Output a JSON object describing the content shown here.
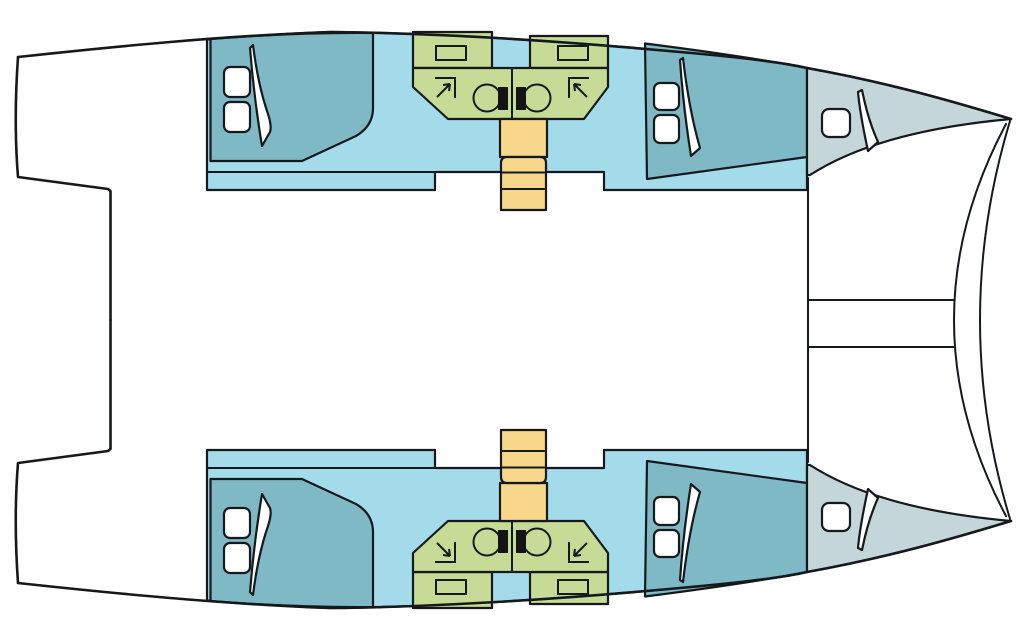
{
  "page": {
    "width": 1028,
    "height": 630,
    "background": "#ffffff"
  },
  "diagram": {
    "type": "boat-floor-plan",
    "subject": "catamaran-layout-top-down-view",
    "orientation": {
      "bow": "right",
      "stern": "left"
    },
    "colors": {
      "background": "#ffffff",
      "outline": "#15191c",
      "cabin_floor": "#a4dbeb",
      "berth": "#7fb9c6",
      "bow_locker": "#c4d6d9",
      "bathroom": "#c6db95",
      "stairs": "#f7d78a",
      "fixture_black": "#141414",
      "hatch_fill": "#ffffff"
    },
    "center_structures": {
      "bridge_deck": {
        "fill_key": "background",
        "contents": "empty"
      },
      "stern_cockpit_recess": {
        "side": "left"
      },
      "bowsprit_beam_lines": 2,
      "bow_bridle_lines": 2
    },
    "hulls": [
      {
        "id": "port-hull",
        "position": "top",
        "compartments": [
          {
            "name": "aft-cabin-berth",
            "color_key": "berth",
            "deck_hatches": 2,
            "door_panels": 1
          },
          {
            "name": "bathroom",
            "color_key": "bathroom",
            "wash_basins": 2,
            "shower_corner_symbols": 2,
            "black_fixtures": 2,
            "mirror_boxes": 2
          },
          {
            "name": "companionway-stairs",
            "color_key": "stairs",
            "steps": 4
          },
          {
            "name": "forward-cabin-berth",
            "color_key": "berth",
            "deck_hatches": 2,
            "door_panels": 1
          },
          {
            "name": "bow-locker",
            "color_key": "bow_locker",
            "deck_hatches": 1,
            "door_panels": 1
          }
        ]
      },
      {
        "id": "starboard-hull",
        "position": "bottom",
        "compartments": [
          {
            "name": "aft-cabin-berth",
            "color_key": "berth",
            "deck_hatches": 2,
            "door_panels": 1
          },
          {
            "name": "bathroom",
            "color_key": "bathroom",
            "wash_basins": 2,
            "shower_corner_symbols": 2,
            "black_fixtures": 2,
            "mirror_boxes": 2
          },
          {
            "name": "companionway-stairs",
            "color_key": "stairs",
            "steps": 4
          },
          {
            "name": "forward-cabin-berth",
            "color_key": "berth",
            "deck_hatches": 2,
            "door_panels": 1
          },
          {
            "name": "bow-locker",
            "color_key": "bow_locker",
            "deck_hatches": 1,
            "door_panels": 1
          }
        ]
      }
    ]
  }
}
